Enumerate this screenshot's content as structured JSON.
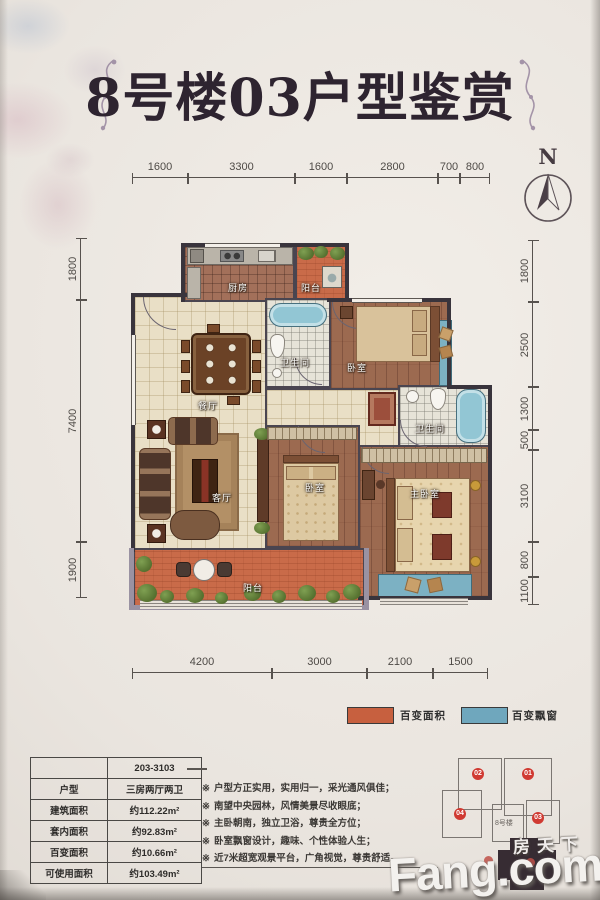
{
  "title": "8号楼03户型鉴赏",
  "compass": {
    "label": "N"
  },
  "dims": {
    "top": [
      "1600",
      "3300",
      "1600",
      "2800",
      "700",
      "800"
    ],
    "bottom": [
      "4200",
      "3000",
      "2100",
      "1500"
    ],
    "left": [
      "1800",
      "7400",
      "1900"
    ],
    "right": [
      "1800",
      "2500",
      "1300",
      "500",
      "3100",
      "800",
      "1100"
    ]
  },
  "rooms": {
    "kitchen": "厨房",
    "balcony_top": "阳台",
    "bathroom_top": "卫生间",
    "bedroom_top": "卧室",
    "dining": "餐厅",
    "living": "客厅",
    "bedroom_mid": "卧室",
    "bathroom_mid": "卫生间",
    "master_bedroom": "主卧室",
    "balcony_bottom": "阳台"
  },
  "legend": {
    "items": [
      {
        "label": "百变面积",
        "color": "#c7603f",
        "swatch": "background:#c7603f"
      },
      {
        "label": "百变飘窗",
        "color": "#6fa7bd",
        "swatch": "background:#6fa7bd"
      }
    ]
  },
  "info_table": {
    "unit_code": "203-3103",
    "rows": [
      {
        "label": "户型",
        "value": "三房两厅两卫"
      },
      {
        "label": "建筑面积",
        "value": "约112.22m²"
      },
      {
        "label": "套内面积",
        "value": "约92.83m²"
      },
      {
        "label": "百变面积",
        "value": "约10.66m²"
      },
      {
        "label": "可使用面积",
        "value": "约103.49m²"
      }
    ]
  },
  "features": {
    "marker": "※",
    "items": [
      "户型方正实用，实用归一，采光通风俱佳；",
      "南望中央园林，风情美景尽收眼底；",
      "主卧朝南，独立卫浴，尊贵全方位；",
      "卧室飘窗设计，趣味、个性体验人生；",
      "近7米超宽观景平台，广角视觉，尊贵舒适。"
    ]
  },
  "key_plan": {
    "building": "8号楼",
    "badges": [
      "02",
      "01",
      "04",
      "03"
    ]
  },
  "watermark": {
    "cn": "房天下",
    "en": "Fang.com"
  },
  "colors": {
    "changeable_area": "#c7603f",
    "bay_window": "#6fa7bd",
    "badge_red": "#d03a32",
    "wall_dark": "#39343c",
    "wall_purple": "#9a92a2",
    "paper": "#eae5df"
  }
}
